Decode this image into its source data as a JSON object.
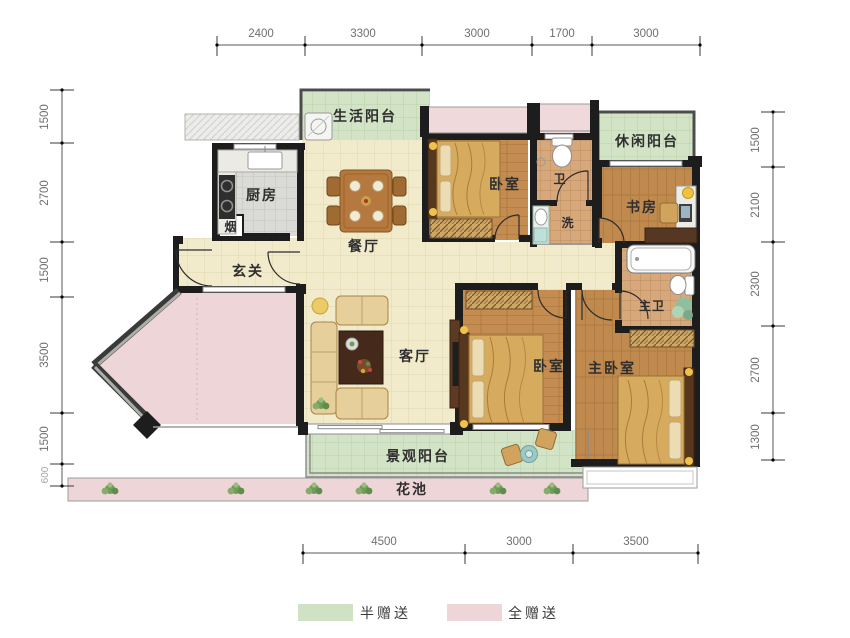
{
  "title": "户型平面图",
  "legend": {
    "half_label": "半赠送",
    "full_label": "全赠送",
    "half_color": "#cfe2c4",
    "full_color": "#eed5d7"
  },
  "rooms": {
    "life_balcony": "生活阳台",
    "kitchen": "厨房",
    "flue": "烟",
    "dining": "餐厅",
    "bedroom1": "卧室",
    "bath": "卫",
    "wash": "洗",
    "leisure_balcony": "休闲阳台",
    "study": "书房",
    "entry": "玄关",
    "living": "客厅",
    "bedroom2": "卧室",
    "master_bedroom": "主卧室",
    "master_bath": "主卫",
    "view_balcony": "景观阳台",
    "flower_bed": "花池"
  },
  "dimensions": {
    "top": [
      "2400",
      "3300",
      "3000",
      "1700",
      "3000"
    ],
    "left": [
      "1500",
      "2700",
      "1500",
      "3500",
      "1500",
      "600"
    ],
    "right": [
      "1500",
      "2100",
      "2300",
      "2700",
      "1300"
    ],
    "bottom": [
      "4500",
      "3000",
      "3500"
    ]
  },
  "colors": {
    "wall": "#1d1d1d",
    "wood": "#c28a4e",
    "cream": "#f2ebcb",
    "green": "#d3e3c6",
    "pink": "#eed5d7"
  }
}
